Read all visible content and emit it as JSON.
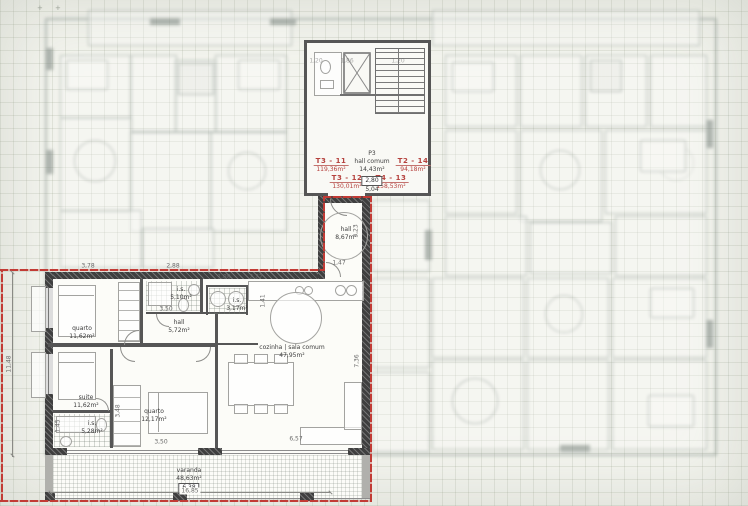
{
  "plan": {
    "units": [
      {
        "id": "T3 - 11",
        "area": "119,36m²"
      },
      {
        "id": "T3 - 12",
        "area": "130,01m²"
      },
      {
        "id": "T4 - 13",
        "area": "158,53m²"
      },
      {
        "id": "T2 - 14",
        "area": "94,18m²"
      }
    ],
    "common_hall": {
      "id": "P3",
      "name": "hall comum",
      "area": "14,43m²",
      "level": "2,80",
      "dim": "5,04"
    },
    "apartment": {
      "rooms": [
        {
          "name": "quarto",
          "area": "11,62m²"
        },
        {
          "name": "i.s.",
          "area": "5,10m²"
        },
        {
          "name": "i.s.",
          "area": "3,17m²"
        },
        {
          "name": "hall",
          "area": "5,72m²"
        },
        {
          "name": "cozinha | sala comum",
          "area": "47,95m²"
        },
        {
          "name": "suite",
          "area": "11,62m²"
        },
        {
          "name": "i.s.",
          "area": "5,28m²"
        },
        {
          "name": "quarto",
          "area": "12,17m²"
        },
        {
          "name": "hall",
          "area": "8,67m²"
        }
      ],
      "balcony": {
        "name": "varanda",
        "area": "48,63m²",
        "level": "6,38",
        "width": "16,85"
      }
    },
    "dimensions": [
      "3,78",
      "2,88",
      "1,88",
      "2,27",
      "3,50",
      "3,50",
      "6,57",
      "11,48",
      "1,45",
      "3,48",
      "7,36",
      "3,23",
      "1,47",
      "1,41",
      "1,20",
      "1,86",
      "1,20"
    ],
    "colors": {
      "boundary": "#c23b35",
      "unit_label": "#b5413d",
      "wall": "#3f3f3f",
      "dim_text": "#6a6a6a"
    }
  }
}
